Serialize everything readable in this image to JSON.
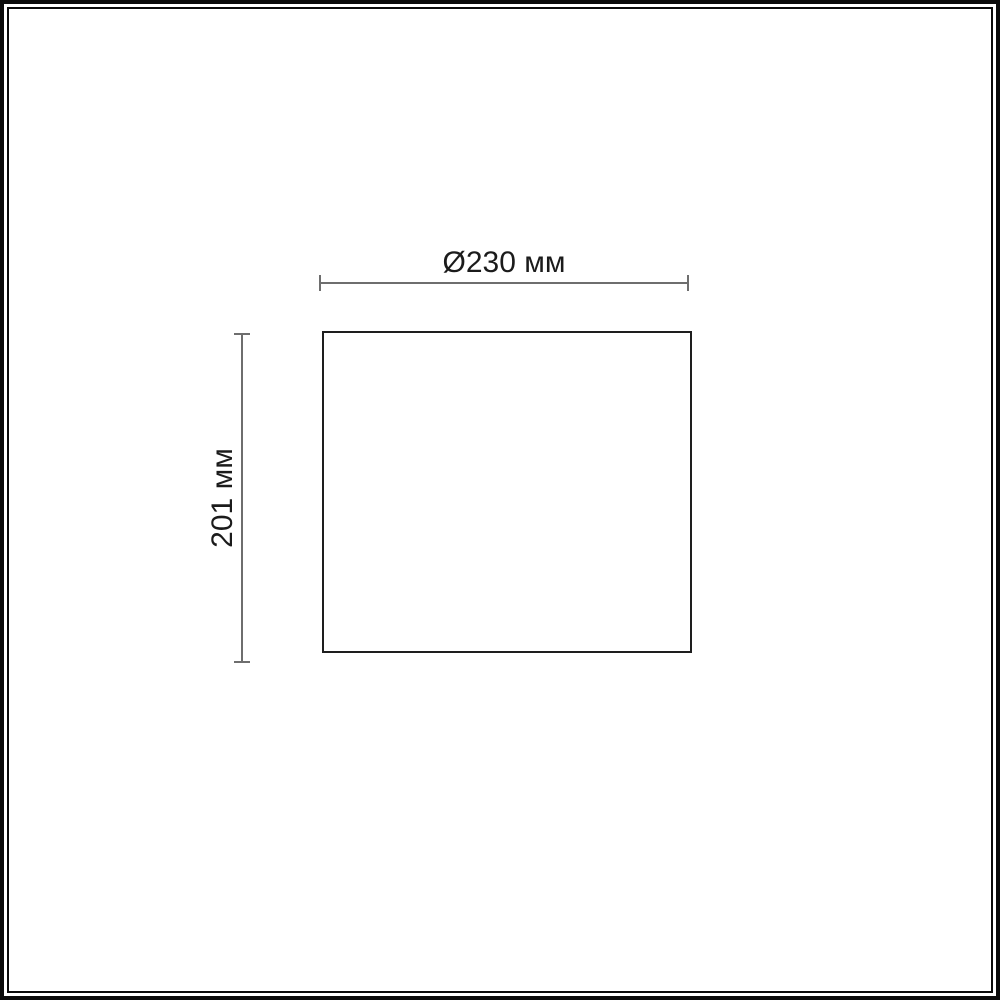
{
  "figure": {
    "type": "technical-dimension-drawing",
    "shape": "rectangle-outline",
    "dimension_width": {
      "label": "Ø230 мм",
      "symbol": "Ø",
      "value": "230",
      "unit": "мм"
    },
    "dimension_height": {
      "label": "201 мм",
      "value": "201",
      "unit": "мм"
    },
    "colors": {
      "background": "#ffffff",
      "frame_border": "#0b0b0b",
      "shape_outline": "#1e1e1e",
      "dimension_line": "#6e6e6e",
      "label_text": "#1b1b1b"
    }
  }
}
